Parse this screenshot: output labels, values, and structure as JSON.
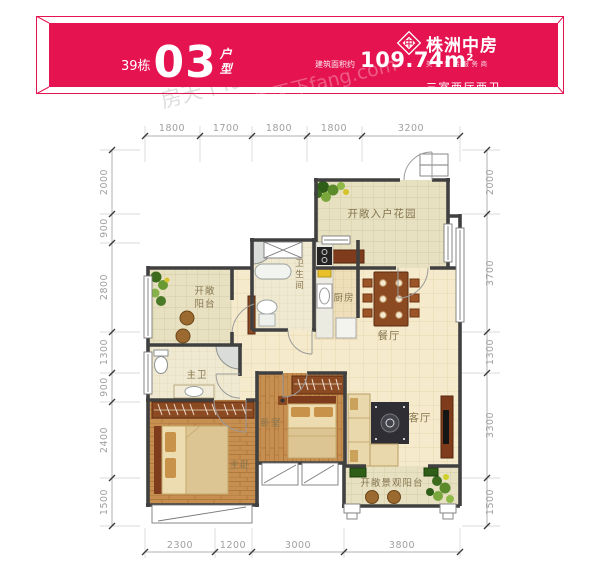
{
  "banner": {
    "building_label": "39栋",
    "unit_number": "03",
    "unit_type_char1": "户",
    "unit_type_char2": "型",
    "area_prefix": "建筑面积约",
    "area_value": "109.74m",
    "area_superscript": "2",
    "brand_name": "株洲中房",
    "brand_tagline": "美好生活服务商",
    "brand_mark": "中",
    "layout_summary": "三室两厅两卫",
    "bg_color": "#e51350"
  },
  "watermark": {
    "text": "房天下fang.com"
  },
  "rooms": {
    "entry_garden": "开敞入户花园",
    "balcony_line1": "开敞",
    "balcony_line2": "阳台",
    "bathroom_chars": [
      "卫",
      "生",
      "间"
    ],
    "kitchen": "厨房",
    "dining": "餐厅",
    "master_bath": "主卫",
    "bedroom": "卧室",
    "master_bedroom": "主卧",
    "living": "客厅",
    "view_balcony": "开敞景观阳台"
  },
  "dims": {
    "top": [
      "1800",
      "1700",
      "1800",
      "1800",
      "3200"
    ],
    "bottom": [
      "2300",
      "1200",
      "3000",
      "3800"
    ],
    "left": [
      "2000",
      "900",
      "2800",
      "1300",
      "900",
      "2400",
      "1500"
    ],
    "right": [
      "2000",
      "3700",
      "1300",
      "3300",
      "1500"
    ]
  }
}
